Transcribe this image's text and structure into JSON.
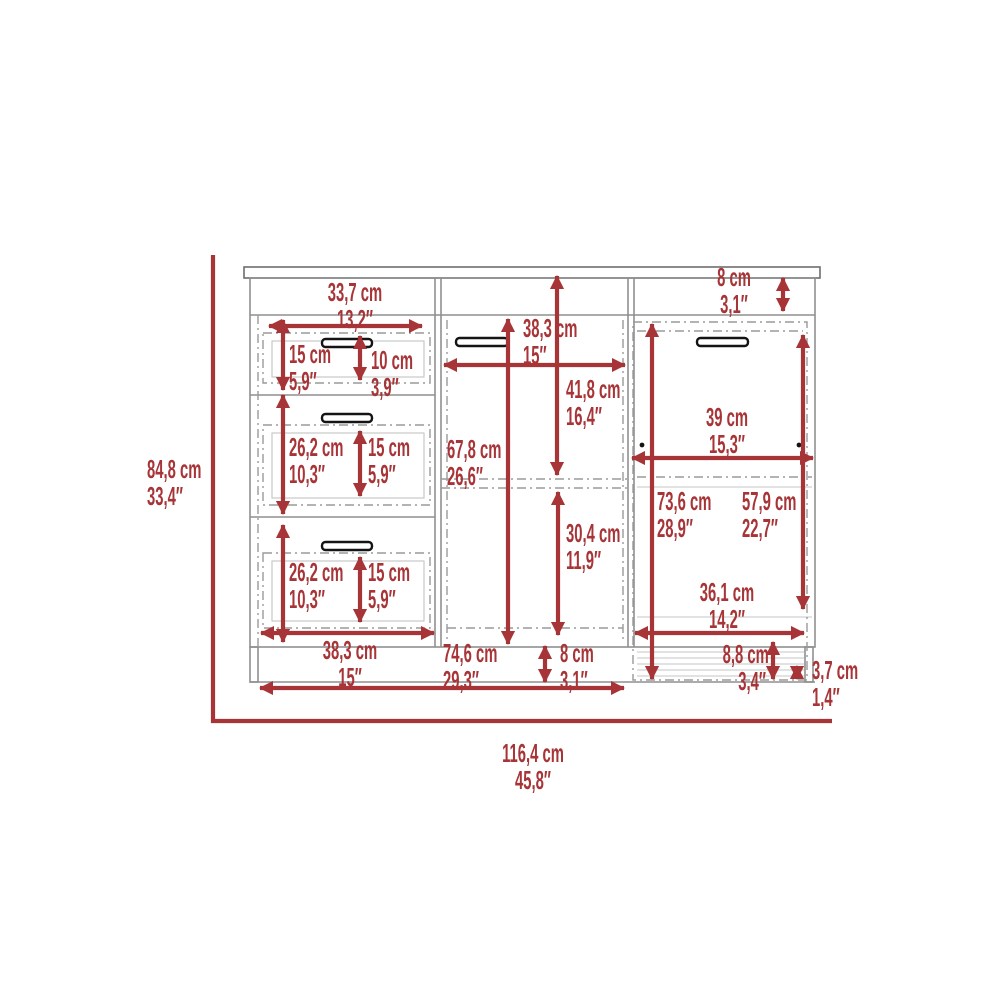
{
  "diagram": {
    "type": "furniture-dimension-drawing",
    "subject": "three-section dresser with three drawers, center door and right door",
    "units": [
      "cm",
      "inches"
    ],
    "accent_color": "#a73437",
    "line_color": "#8f8f8f"
  },
  "icons": {
    "drawer_handle": "drawer-handle-icon",
    "door_handle": "door-handle-icon",
    "door_pin": "door-pin-dot"
  },
  "dims": {
    "overall_height": {
      "cm": "84,8 cm",
      "in": "33,4″"
    },
    "overall_width": {
      "cm": "116,4 cm",
      "in": "45,8″"
    },
    "top_drawer_width": {
      "cm": "33,7 cm",
      "in": "13,2″"
    },
    "top_rail_height": {
      "cm": "8 cm",
      "in": "3,1″"
    },
    "drawer1_opening": {
      "cm": "15 cm",
      "in": "5,9″"
    },
    "drawer1_front": {
      "cm": "10 cm",
      "in": "3,9″"
    },
    "drawer2_height": {
      "cm": "26,2 cm",
      "in": "10,3″"
    },
    "drawer2_front": {
      "cm": "15 cm",
      "in": "5,9″"
    },
    "drawer3_height": {
      "cm": "26,2 cm",
      "in": "10,3″"
    },
    "drawer3_front": {
      "cm": "15 cm",
      "in": "5,9″"
    },
    "left_column_width": {
      "cm": "38,3 cm",
      "in": "15″"
    },
    "middle_column_width": {
      "cm": "38,3 cm",
      "in": "15″"
    },
    "upper_cavity_height": {
      "cm": "41,8 cm",
      "in": "16,4″"
    },
    "middle_door_height": {
      "cm": "67,8 cm",
      "in": "26,6″"
    },
    "lower_cavity_height": {
      "cm": "30,4 cm",
      "in": "11,9″"
    },
    "base_height_middle": {
      "cm": "8 cm",
      "in": "3,1″"
    },
    "bottom_span": {
      "cm": "74,6 cm",
      "in": "29,3″"
    },
    "right_door_width": {
      "cm": "39 cm",
      "in": "15,3″"
    },
    "right_door_height": {
      "cm": "73,6 cm",
      "in": "28,9″"
    },
    "right_inner_height": {
      "cm": "57,9 cm",
      "in": "22,7″"
    },
    "right_inner_width": {
      "cm": "36,1 cm",
      "in": "14,2″"
    },
    "base_height_right": {
      "cm": "8,8 cm",
      "in": "3,4″"
    },
    "leg_height": {
      "cm": "3,7 cm",
      "in": "1,4″"
    }
  }
}
